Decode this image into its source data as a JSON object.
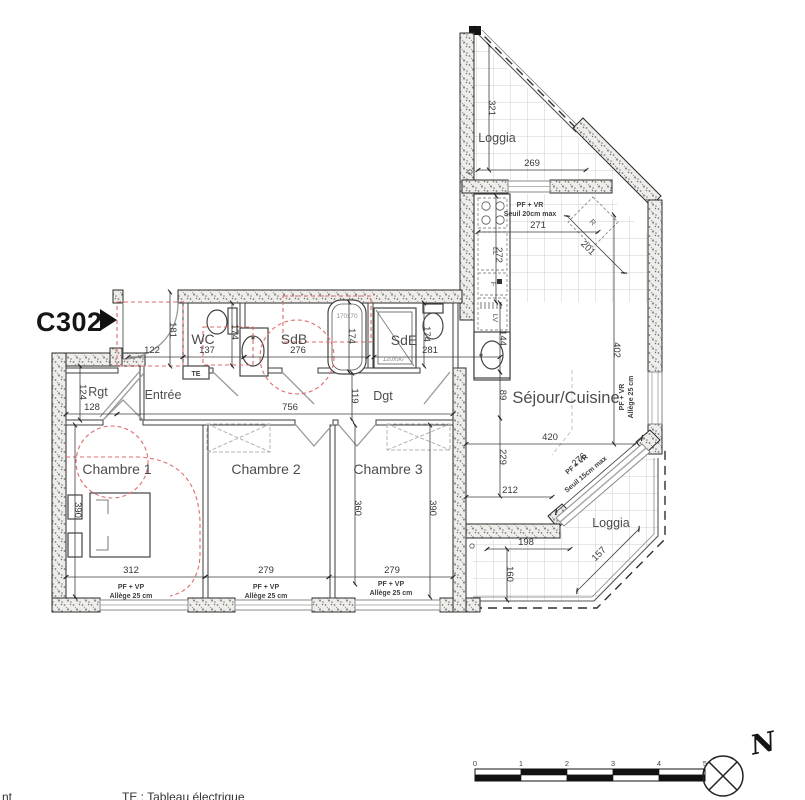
{
  "plan": {
    "id": "C302",
    "legend_te": "TE : Tableau électrique",
    "legend_left_partial": "nt"
  },
  "rooms": {
    "loggia_top": "Loggia",
    "loggia_bottom": "Loggia",
    "sejour": "Séjour/Cuisine",
    "wc": "WC",
    "sdb": "SdB",
    "sde": "SdE",
    "entree": "Entrée",
    "dgt": "Dgt",
    "rgt": "Rgt",
    "ch1": "Chambre 1",
    "ch2": "Chambre 2",
    "ch3": "Chambre 3"
  },
  "dims": {
    "loggia_top_h": "321",
    "loggia_top_w": "269",
    "kitchen_w": "271",
    "kitchen_h": "272",
    "fridge_diag": "201",
    "sejour_h1": "144",
    "sejour_h2": "89",
    "sejour_h3": "229",
    "sejour_right_h": "402",
    "sejour_w": "420",
    "sejour_diag": "276",
    "sejour_w2": "212",
    "loggia_bot_w": "198",
    "loggia_bot_h": "160",
    "loggia_bot_diag": "157",
    "entree_h": "181",
    "entree_w": "122",
    "wc_w": "137",
    "wc_h": "174",
    "sdb_w": "276",
    "bathtub_len": "174",
    "sde_w": "281",
    "sde_h": "174",
    "rgt_h": "124",
    "rgt_w": "128",
    "corridor_w": "756",
    "corridor_h": "119",
    "ch1_h": "390",
    "ch1_w": "312",
    "ch2_h": "360",
    "ch2_w": "279",
    "ch3_h": "390",
    "ch3_w": "279"
  },
  "notes": {
    "loggia_door": [
      "PF + VR",
      "Seuil 20cm max"
    ],
    "window_right": [
      "PF + VR",
      "Allège 25 cm"
    ],
    "window_diag": [
      "PF + VR",
      "Seuil 15cm max"
    ],
    "bedroom_window": [
      "PF + VP",
      "Allège 25 cm"
    ]
  },
  "fixtures": {
    "te": "TE",
    "bathtub_size": "170x70",
    "shower_size": "120x90",
    "fridge": "R",
    "washer": "LL",
    "oven": "F",
    "dishwasher": "LV"
  },
  "scale_bar": {
    "labels": [
      "0",
      "1",
      "2",
      "3",
      "4",
      "5"
    ]
  },
  "compass": {
    "label": "N"
  },
  "colors": {
    "red_dashed": "#e06a6a",
    "tile_line": "#cfcfcf",
    "wall_fill": "#efedea"
  }
}
